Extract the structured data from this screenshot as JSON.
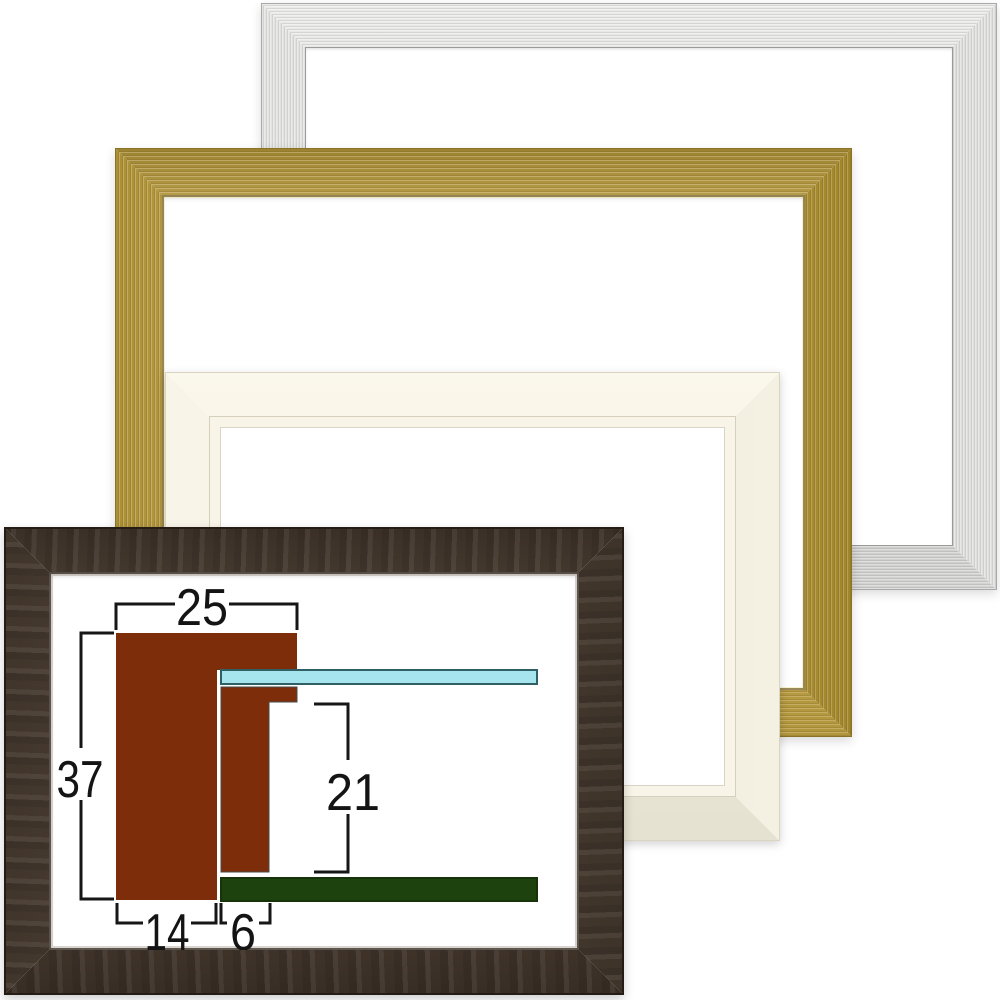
{
  "frames": {
    "silver": {
      "finish": "brushed silver",
      "color": "#cdcdcb"
    },
    "gold": {
      "finish": "brushed gold",
      "color": "#c0a54b"
    },
    "ivory": {
      "finish": "ivory white",
      "color": "#f4f0e2"
    },
    "brown": {
      "finish": "dark brown wood",
      "color": "#55463a"
    }
  },
  "diagram": {
    "type": "frame-moulding-cross-section",
    "measurements": {
      "overall_width": "25",
      "overall_height": "37",
      "rabbet_depth": "21",
      "face_width": "14",
      "lip_width": "6"
    },
    "colors": {
      "moulding": "#7e2d0b",
      "glass": "#a7e5ee",
      "backboard": "#1d420e",
      "dimension_lines": "#161616"
    }
  }
}
